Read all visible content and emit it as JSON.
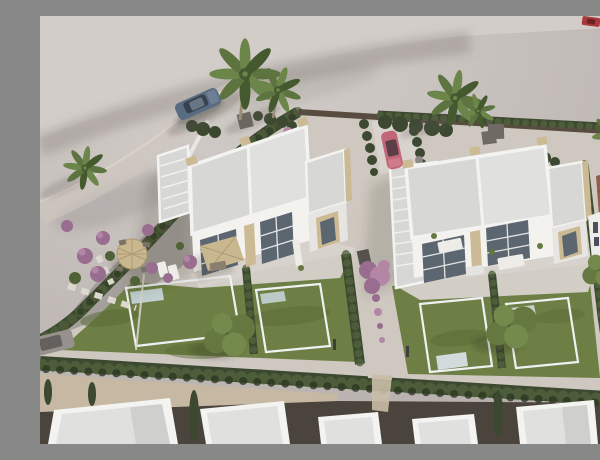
{
  "meta": {
    "kind": "aerial-architectural-render",
    "width": 600,
    "height": 428
  },
  "scene": {
    "description": "Aerial 3D render of a residential development: two pairs of modern white semi-detached villas with flat roofs, private pools and lawned gardens, separated by cypress hedges; sandy vacant lot above with palm trees and parked cars, a hedge-lined street with neighbouring white rooftops along the bottom, and a terracotta-roofed house on the right.",
    "objects": [
      {
        "label": "sandy-vacant-lot",
        "position": "top"
      },
      {
        "label": "left-duplex-villa",
        "kind": "building"
      },
      {
        "label": "right-duplex-villa",
        "kind": "building"
      },
      {
        "label": "terracotta-roof-house",
        "kind": "building",
        "position": "right"
      },
      {
        "label": "neighbour-rooftop",
        "kind": "building-row",
        "count": 6,
        "position": "bottom"
      },
      {
        "label": "swimming-pool",
        "count": 4
      },
      {
        "label": "lawn",
        "count": 2
      },
      {
        "label": "perimeter-hedge",
        "position": "left-curve"
      },
      {
        "label": "street-hedge",
        "position": "bottom"
      },
      {
        "label": "boundary-wall",
        "position": "top-right"
      },
      {
        "label": "palm-tree",
        "count": 6
      },
      {
        "label": "garden-tree",
        "count": 3
      },
      {
        "label": "purple-flowering-tree",
        "count": 1
      },
      {
        "label": "purple-shrub",
        "count": 8
      },
      {
        "label": "round-parasol-with-chairs",
        "position": "left-garden"
      },
      {
        "label": "square-parasol-terrace",
        "position": "left-villa"
      },
      {
        "label": "sun-lounger",
        "count": 2
      },
      {
        "label": "outdoor-sofa-set",
        "count": 2
      },
      {
        "label": "roof-access-stairs",
        "count": 2
      },
      {
        "label": "stepping-stone-path",
        "position": "left-garden"
      },
      {
        "label": "suv-car",
        "color": "blue-grey",
        "position": "top-road"
      },
      {
        "label": "parked-car",
        "color": "pink",
        "position": "center-driveway"
      },
      {
        "label": "parked-car",
        "color": "grey",
        "position": "left-edge"
      },
      {
        "label": "parked-car",
        "color": "silver",
        "position": "behind-top-wall"
      },
      {
        "label": "car",
        "color": "red",
        "position": "top-right-corner"
      },
      {
        "label": "street",
        "position": "bottom"
      }
    ]
  },
  "palette": {
    "sandHi": "#d6d0cc",
    "sandLo": "#b1aaa8",
    "sandArc": "#d3cdca",
    "plot": "#cec8c0",
    "terr": "#d8d3cc",
    "gravel": "#9d9994",
    "grass": "#6d7f44",
    "grassD": "#596b36",
    "hedge": "#3c4930",
    "hedgeL": "#51613c",
    "hedgeD": "#2c3722",
    "poolHi": "#cfdde8",
    "poolLo": "#8ea9c0",
    "poolHi2": "#d7e0e8",
    "poolLo2": "#a7bccd",
    "roof": "#e0e0de",
    "roofD": "#d7d7d5",
    "parapet": "#f3f3f1",
    "wall": "#f3f2ef",
    "wallD": "#e7e5e1",
    "win": "#5c6671",
    "winD": "#49525c",
    "stone": "#ccba95",
    "roadB": "#c6b8a2",
    "dark": "#4b443c",
    "wallTop": "#584c40",
    "tan": "#c9b78f",
    "tanD": "#ae9b75",
    "purple": "#996d90",
    "purpleL": "#b286a4",
    "terra": "#8f6048",
    "terraD": "#7a503c",
    "white": "#eeece8",
    "grayF": "#6f6a64",
    "carBlue": "#5a6c82",
    "carPink": "#c2677a",
    "carGray": "#97918d",
    "carRed": "#a8393d",
    "carSilver": "#d2d3d4",
    "palm1": "#45592f",
    "palm2": "#5d7440",
    "palm3": "#6c8549",
    "tree1": "#4f6136",
    "tree2": "#647840",
    "tree3": "#74894c",
    "trunk": "#9b8d77"
  }
}
